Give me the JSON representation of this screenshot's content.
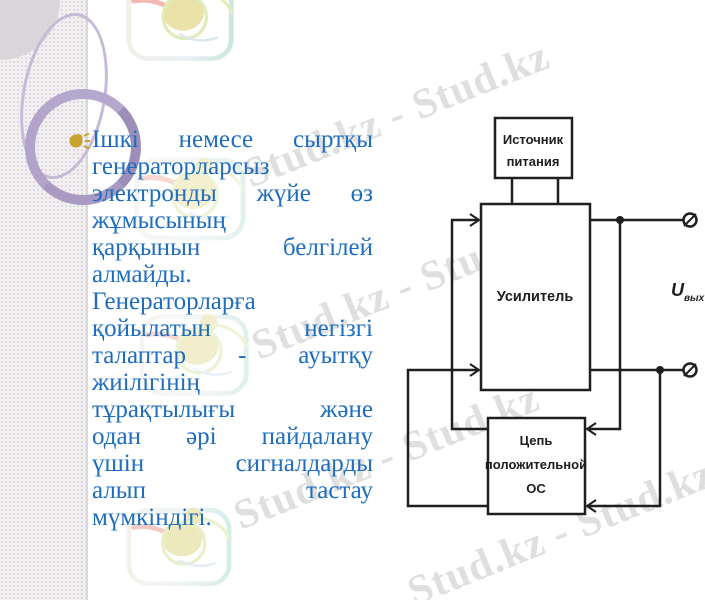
{
  "watermark": {
    "text": "Stud.kz - Stud.kz",
    "color": "#dadada"
  },
  "text": {
    "color": "#1e6dbe",
    "lines": [
      {
        "text": "Ішкі немесе сыртқы",
        "justify": true
      },
      {
        "text": "генераторларсыз",
        "justify": false
      },
      {
        "text": "электронды жүйе өз",
        "justify": true
      },
      {
        "text": "жұмысының",
        "justify": false
      },
      {
        "text": "қарқынын белгілей",
        "justify": true
      },
      {
        "text": "алмайды.",
        "justify": false
      },
      {
        "text": "Генераторларға",
        "justify": false
      },
      {
        "text": "қойылатын негізгі",
        "justify": true
      },
      {
        "text": "талаптар - ауытқу",
        "justify": true
      },
      {
        "text": "жиілігінің",
        "justify": false
      },
      {
        "text": "тұрақтылығы және",
        "justify": true
      },
      {
        "text": "одан әрі пайдалану",
        "justify": true
      },
      {
        "text": "үшін сигналдарды",
        "justify": true
      },
      {
        "text": "алып тастау",
        "justify": true
      },
      {
        "text": "мүмкіндігі.",
        "justify": false
      }
    ]
  },
  "diagram": {
    "power_box": [
      "Источник",
      "питания"
    ],
    "amplifier_box": "Усилитель",
    "feedback_box": [
      "Цепь",
      "положительной",
      "ОС"
    ],
    "output_label": {
      "base": "U",
      "sub": "вых"
    },
    "line_color": "#1f1f1f"
  },
  "colors": {
    "body_text_blue": "#1e6dbe",
    "watermark_gray": "#dadada",
    "sidebar_ring_purple": "#a89ac3",
    "diagram_line": "#1f1f1f",
    "bullet_gold": "#c9a22b"
  }
}
